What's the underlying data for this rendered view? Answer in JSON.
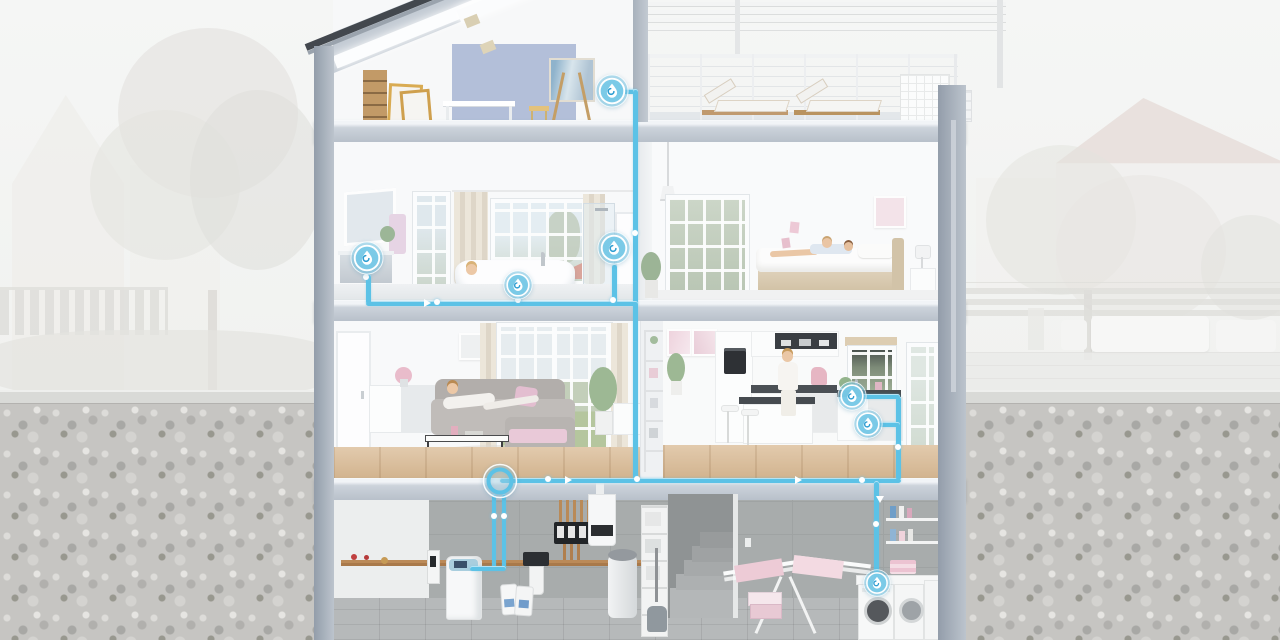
{
  "meta": {
    "title": "house-cross-section-water-system",
    "type": "cutaway-diagram",
    "visible_text": []
  },
  "colors": {
    "pipe": "#5cc2e6",
    "marker_fill": "#7ecbe9",
    "marker_ring": "#ffffff",
    "marker_drop_swirl": "#2f9ed2",
    "slab": "#c3cad4",
    "exterior_wall": "#a2abb7",
    "concrete": "#a8acac",
    "wood_floor": "#dcbf9b",
    "accent_wall": "#adbad6",
    "background_wash": "#f3f4f3",
    "gravel": "#c6c5c2"
  },
  "diagram": {
    "markers": [
      {
        "id": "attic-studio",
        "label": "water point – attic studio",
        "x": 612,
        "y": 91,
        "d": 34
      },
      {
        "id": "bathroom-vanity",
        "label": "water point – washbasin",
        "x": 367,
        "y": 258,
        "d": 34
      },
      {
        "id": "bathroom-bathtub",
        "label": "water point – bathtub",
        "x": 518,
        "y": 285,
        "d": 30
      },
      {
        "id": "bathroom-shower",
        "label": "water point – shower",
        "x": 614,
        "y": 248,
        "d": 34
      },
      {
        "id": "kitchen-sink",
        "label": "water point – kitchen sink",
        "x": 852,
        "y": 396,
        "d": 30
      },
      {
        "id": "kitchen-dishwasher",
        "label": "water point – dishwasher",
        "x": 868,
        "y": 424,
        "d": 30
      },
      {
        "id": "laundry-washing-machine",
        "label": "water point – washing machine",
        "x": 877,
        "y": 583,
        "d": 28
      }
    ],
    "junction": {
      "id": "main-connection",
      "label": "central water connection",
      "x": 500,
      "y": 481,
      "d": 36
    },
    "pipes": [
      {
        "x": 615,
        "y": 89,
        "w": 22,
        "h": 5
      },
      {
        "x": 633,
        "y": 89,
        "w": 5,
        "h": 392
      },
      {
        "x": 366,
        "y": 301,
        "w": 272,
        "h": 5
      },
      {
        "x": 366,
        "y": 274,
        "w": 5,
        "h": 30
      },
      {
        "x": 516,
        "y": 296,
        "w": 5,
        "h": 8
      },
      {
        "x": 612,
        "y": 264,
        "w": 5,
        "h": 40
      },
      {
        "x": 500,
        "y": 478,
        "w": 401,
        "h": 5
      },
      {
        "x": 896,
        "y": 396,
        "w": 5,
        "h": 84
      },
      {
        "x": 860,
        "y": 394,
        "w": 40,
        "h": 5
      },
      {
        "x": 876,
        "y": 422,
        "w": 24,
        "h": 5
      },
      {
        "x": 874,
        "y": 481,
        "w": 5,
        "h": 98
      },
      {
        "x": 492,
        "y": 494,
        "w": 4,
        "h": 76
      },
      {
        "x": 502,
        "y": 494,
        "w": 4,
        "h": 76
      },
      {
        "x": 470,
        "y": 566,
        "w": 36,
        "h": 5
      }
    ],
    "dots": [
      [
        366,
        277
      ],
      [
        437,
        302
      ],
      [
        518,
        300
      ],
      [
        613,
        300
      ],
      [
        635,
        233
      ],
      [
        548,
        479
      ],
      [
        637,
        479
      ],
      [
        862,
        480
      ],
      [
        898,
        447
      ],
      [
        494,
        516
      ],
      [
        504,
        516
      ],
      [
        876,
        524
      ]
    ],
    "arrows": [
      {
        "x": 424,
        "y": 303,
        "dir": "right"
      },
      {
        "x": 565,
        "y": 480,
        "dir": "right"
      },
      {
        "x": 795,
        "y": 480,
        "dir": "right"
      },
      {
        "x": 876,
        "y": 500,
        "dir": "down"
      }
    ]
  },
  "scene": {
    "rooms": [
      {
        "name": "attic-studio"
      },
      {
        "name": "roof-terrace"
      },
      {
        "name": "bathroom"
      },
      {
        "name": "bedroom"
      },
      {
        "name": "living-room"
      },
      {
        "name": "kitchen"
      },
      {
        "name": "utility-room"
      },
      {
        "name": "laundry-room"
      }
    ],
    "equipment": [
      "water-softener",
      "water-filter",
      "wall-boiler",
      "heating-manifold",
      "hot-water-tank",
      "salt-bags",
      "washing-machine",
      "dryer",
      "drying-rack"
    ]
  }
}
